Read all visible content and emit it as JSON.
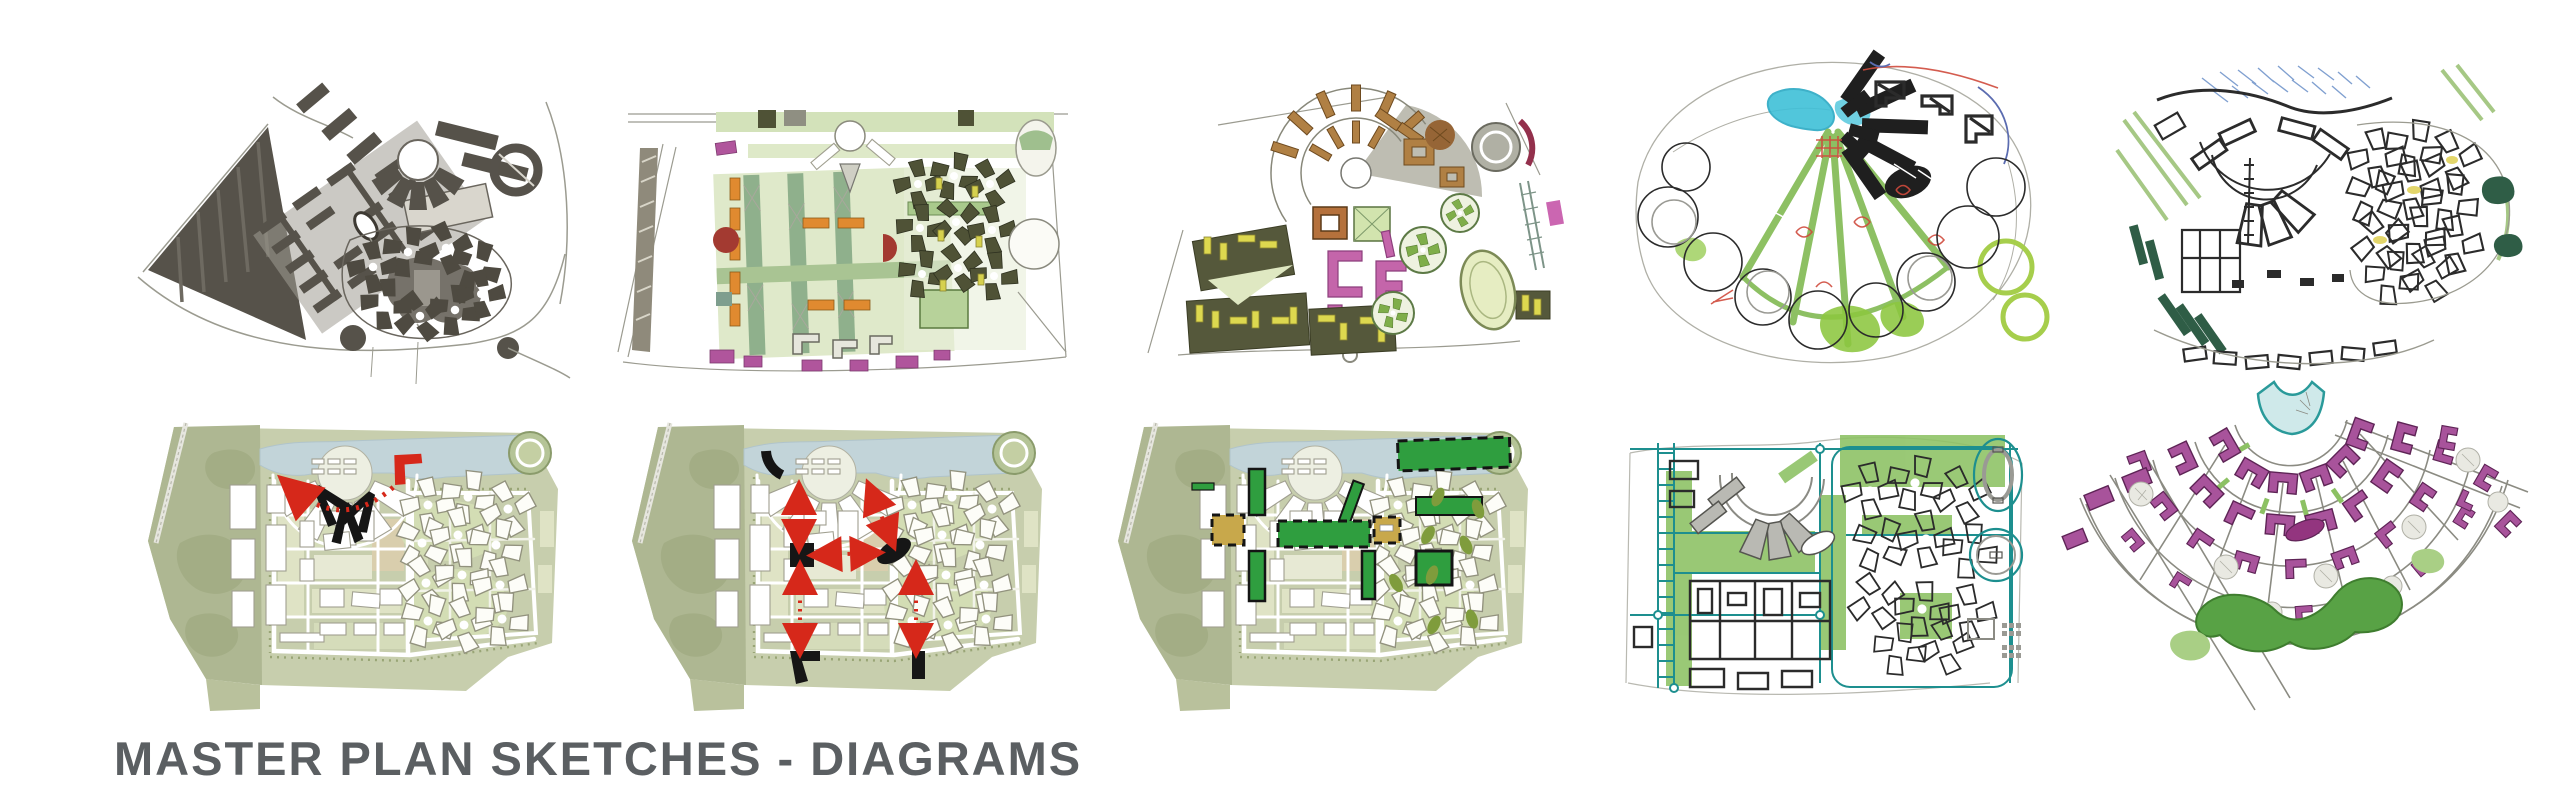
{
  "page": {
    "width": 2560,
    "height": 795,
    "background_color": "#ffffff"
  },
  "title": {
    "text": "MASTER PLAN SKETCHES - DIAGRAMS",
    "color": "#5b5f62"
  },
  "board": {
    "rows": 2,
    "columns": 5,
    "panel_count": 10
  },
  "panels": [
    {
      "id": "sketch-01",
      "name": "figure-ground-marker-plan",
      "row": 1,
      "col": 1,
      "key_colors": [
        "#56524a",
        "#76726a",
        "#a19d94"
      ]
    },
    {
      "id": "sketch-02",
      "name": "color-study-plan-orange-green",
      "row": 1,
      "col": 2,
      "key_colors": [
        "#d7e3bd",
        "#8fb08c",
        "#e08a30",
        "#b0559c",
        "#a33a31",
        "#4f5236"
      ]
    },
    {
      "id": "sketch-03",
      "name": "color-study-plan-ochre-yellow-pink",
      "row": 1,
      "col": 3,
      "key_colors": [
        "#b08044",
        "#ddd84f",
        "#c465aa",
        "#7fae4a",
        "#b7b6aa"
      ]
    },
    {
      "id": "sketch-04",
      "name": "loose-pen-concept-radial-bubbles",
      "row": 1,
      "col": 4,
      "key_colors": [
        "#1f1f1f",
        "#3fc0d8",
        "#cf4a3c",
        "#8cc63f",
        "#5b6cb0"
      ]
    },
    {
      "id": "sketch-05",
      "name": "ink-fan-masterplan-sketch",
      "row": 1,
      "col": 5,
      "key_colors": [
        "#2b2b2b",
        "#6a8fc8",
        "#9cc278",
        "#2f5d46",
        "#e3d66b"
      ]
    },
    {
      "id": "sketch-06",
      "name": "masterplan-diagram-red-arc-axis",
      "row": 2,
      "col": 1,
      "key_colors": [
        "#c7cead",
        "#c2d4d9",
        "#161616",
        "#d6281a"
      ]
    },
    {
      "id": "sketch-07",
      "name": "masterplan-diagram-connection-arrows",
      "row": 2,
      "col": 2,
      "key_colors": [
        "#c7cead",
        "#c2d4d9",
        "#161616",
        "#d6281a"
      ]
    },
    {
      "id": "sketch-08",
      "name": "masterplan-diagram-green-open-spaces",
      "row": 2,
      "col": 3,
      "key_colors": [
        "#c7cead",
        "#2f9e3f",
        "#c8a84b",
        "#7f9c3c"
      ]
    },
    {
      "id": "sketch-09",
      "name": "teal-ink-framework-diagram",
      "row": 2,
      "col": 4,
      "key_colors": [
        "#1d8f8f",
        "#8cc163",
        "#b9b9b3",
        "#2b2b2b"
      ]
    },
    {
      "id": "sketch-10",
      "name": "fan-plan-purple-buildings",
      "row": 2,
      "col": 5,
      "key_colors": [
        "#a8539b",
        "#58a245",
        "#cfe9ea",
        "#8b8b82"
      ]
    }
  ]
}
